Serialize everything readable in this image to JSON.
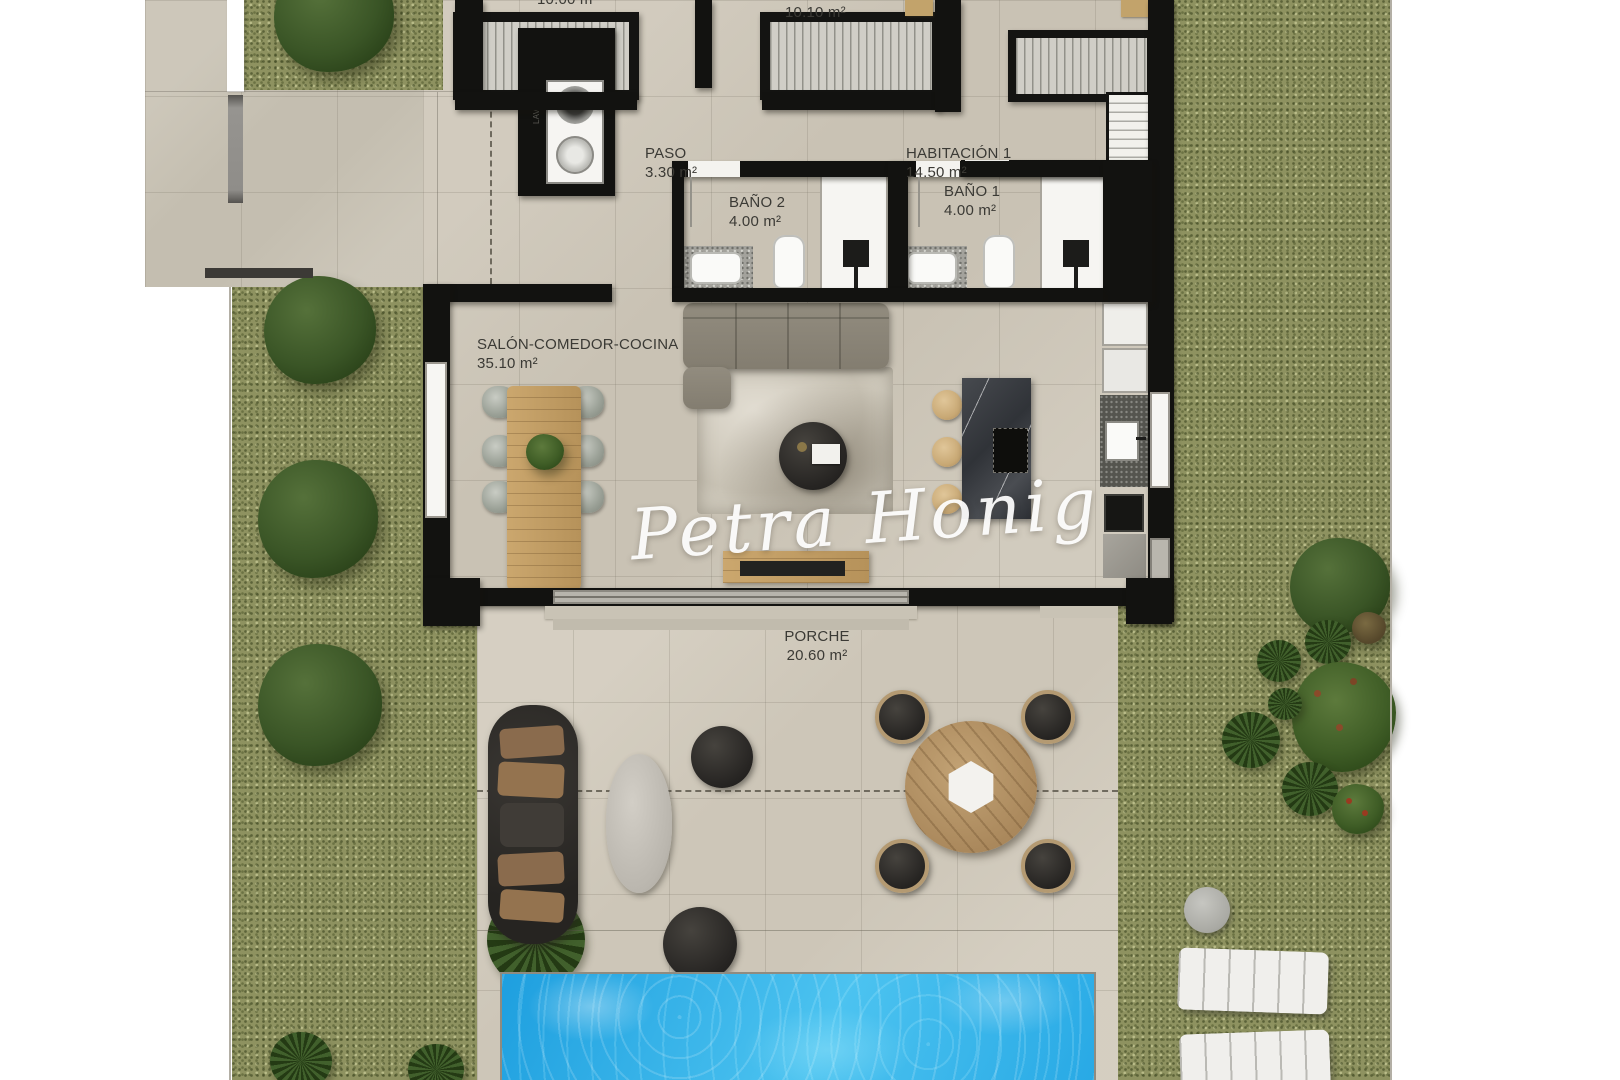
{
  "watermark": {
    "text": "Petra Honig"
  },
  "rooms": {
    "bedroom3": {
      "area": "10.00 m²"
    },
    "bedroom2": {
      "area": "10.10 m²"
    },
    "habitacion1": {
      "name": "HABITACIÓN 1",
      "area": "14.50 m²"
    },
    "paso": {
      "name": "PASO",
      "area": "3.30 m²"
    },
    "bano2": {
      "name": "BAÑO 2",
      "area": "4.00 m²"
    },
    "bano1": {
      "name": "BAÑO 1",
      "area": "4.00 m²"
    },
    "salon": {
      "name": "SALÓN-COMEDOR-COCINA",
      "area": "35.10 m²"
    },
    "porche": {
      "name": "PORCHE",
      "area": "20.60 m²"
    }
  },
  "laundry": {
    "label": "LAVADO"
  },
  "colors": {
    "grass": "#8e9260",
    "paving": "#cfc8ba",
    "wall": "#121210",
    "pool_water": "#2fb1ea",
    "wood": "#c3a06b",
    "outdoor_dark": "#2e2c29"
  }
}
